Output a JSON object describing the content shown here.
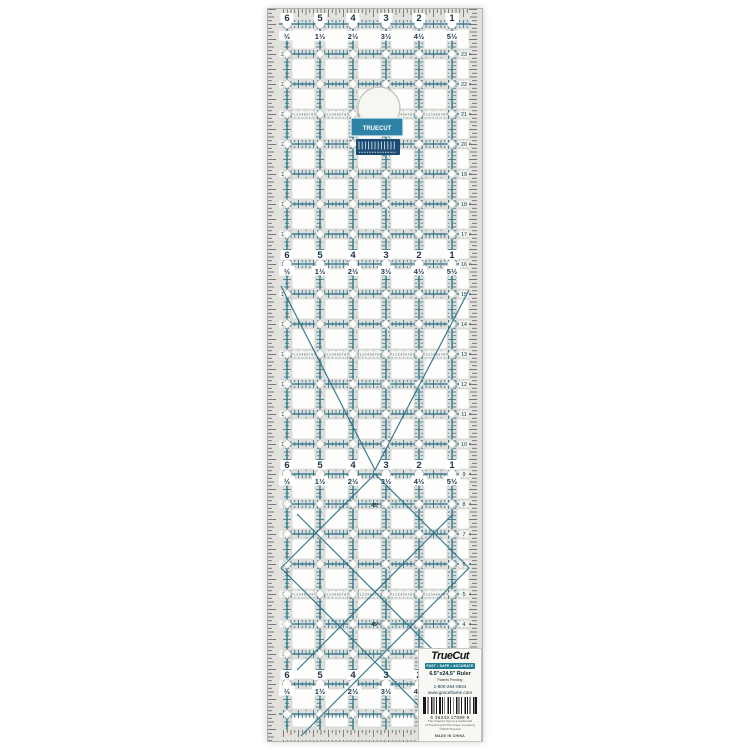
{
  "ruler": {
    "top_scale": [
      "6",
      "5",
      "4",
      "3",
      "2",
      "1"
    ],
    "half_scale": [
      "½",
      "1½",
      "2½",
      "3½",
      "4½",
      "5½"
    ],
    "row_labels": [
      "23",
      "22",
      "21",
      "20",
      "19",
      "18",
      "17",
      "16",
      "15",
      "14",
      "13",
      "12",
      "11",
      "10",
      "9",
      "8",
      "7",
      "6",
      "5",
      "4",
      "3",
      "2"
    ],
    "eighth_labels": "1 2 3 4 5 6 7 8",
    "angle_label": "45°",
    "sticker_text": "TRUECUT"
  },
  "label": {
    "brand": "TrueCut",
    "tagline": "FAST • SAFE • ACCURATE",
    "product_name": "6.5\"x24.5\" Ruler",
    "sub": "Patents Pending",
    "phone": "1-800-264-0644",
    "website": "www.graceframe.com",
    "barcode": "6  36343 17089  9",
    "fine_print": [
      "The TrueCut logo is a trademark",
      "of TrueCut and The Grace Company",
      "©2010 TrueCut"
    ],
    "made_in": "MADE IN CHINA"
  },
  "colors": {
    "grid_teal": "#266f86",
    "numbers": "#1f3545",
    "body_gray": "#dededa",
    "edge_gray": "#e2e1dd",
    "square_white": "#fdfdfb",
    "tick_dark": "#54534e",
    "sticker_blue": "#2e82a6",
    "sticker_navy": "#1c4a70",
    "label_teal": "#1e7d93"
  }
}
